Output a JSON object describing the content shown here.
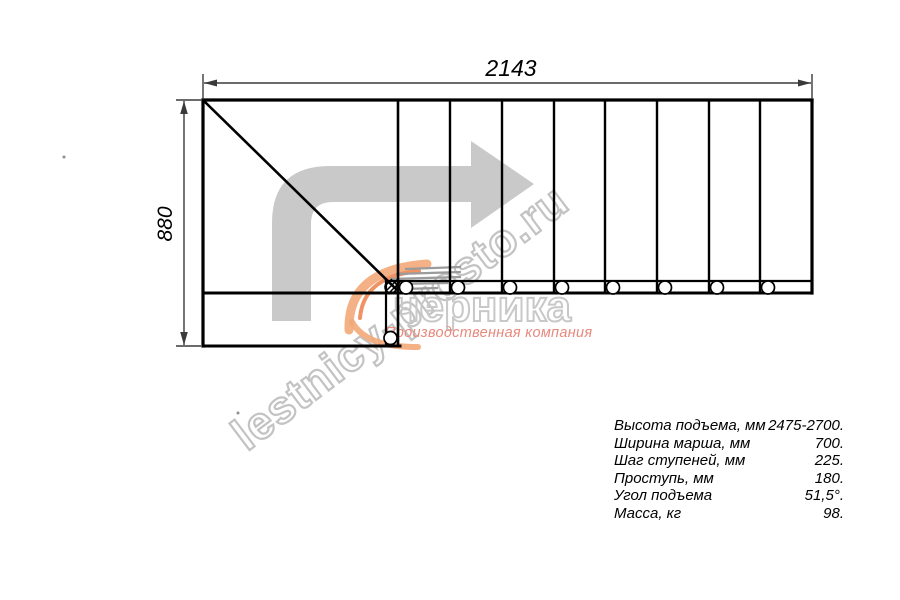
{
  "dimensions": {
    "total_run_mm": "2143",
    "total_width_mm": "880"
  },
  "specs": {
    "rows": [
      {
        "label": "Высота подъема, мм",
        "value": "2475-2700."
      },
      {
        "label": "Ширина марша, мм",
        "value": "700."
      },
      {
        "label": "Шаг ступеней, мм",
        "value": "225."
      },
      {
        "label": "Проступь, мм",
        "value": "180."
      },
      {
        "label": "Угол подъема",
        "value": "51,5°."
      },
      {
        "label": "Масса, кг",
        "value": "98."
      }
    ]
  },
  "watermark": {
    "site_text": "lestnicy-prosto.ru",
    "logo_text": "черника",
    "logo_subtext": "Производственная компания"
  },
  "colors": {
    "line_black": "#000000",
    "dimension_gray": "#3a3a3a",
    "arrow_gray": "#c9c9c9",
    "watermark_gray": "#c3c3c3",
    "logo_orange_light": "#f2a878",
    "logo_orange_dark": "#ec7f49",
    "logo_red_text": "#e8897c"
  }
}
